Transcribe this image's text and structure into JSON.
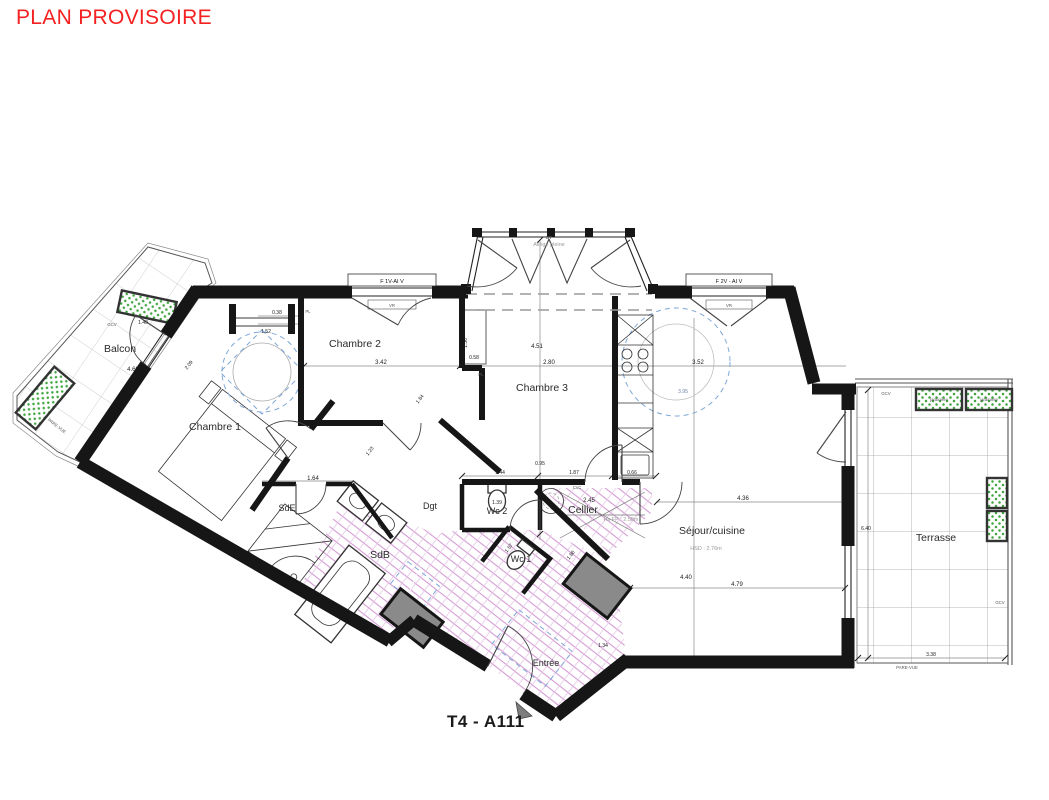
{
  "title": "PLAN PROVISOIRE",
  "plan_code": "T4 - A111",
  "rooms": {
    "balcon": {
      "label": "Balcon"
    },
    "chambre1": {
      "label": "Chambre 1"
    },
    "chambre2": {
      "label": "Chambre 2"
    },
    "chambre3": {
      "label": "Chambre 3"
    },
    "sde": {
      "label": "SdE"
    },
    "sdb": {
      "label": "SdB"
    },
    "dgt": {
      "label": "Dgt"
    },
    "wc2": {
      "label": "Wc 2"
    },
    "wc1": {
      "label": "Wc 1"
    },
    "cellier": {
      "label": "Cellier",
      "height_note": "Hs FP : 2.58m"
    },
    "sejour": {
      "label": "Séjour/cuisine",
      "height_note": "HSD : 2.76m"
    },
    "entree": {
      "label": "Entrée"
    },
    "terrasse": {
      "label": "Terrasse"
    }
  },
  "windows": {
    "f1": "F 1V-AI V",
    "f2": "F 2V - AI V",
    "vr": "VR",
    "bay_tag": "BT",
    "bay_note": "Allège pleine"
  },
  "annotations": {
    "gcv": "GCV",
    "pare_vue": "PARE-VUE",
    "pl": "PL",
    "csc": "CsC",
    "jardiniere": "jardinière"
  },
  "dims": {
    "balcon_length": "4.60",
    "balcon_width": "1.40",
    "ch1_placard_a": "0.38",
    "ch1_placard_b": "1.52",
    "ch1_door": "2.09",
    "ch2_width": "3.42",
    "ch2_side_a": "1.56",
    "ch2_side_b": "0.58",
    "ch3_length": "4.51",
    "ch3_width": "2.80",
    "sejour_a": "4.36",
    "sejour_b": "4.40",
    "sejour_c": "4.79",
    "sejour_d": "3.52",
    "sejour_e": "3.95",
    "kitchen_depth": "0.66",
    "wc2_chain_a": "1.44",
    "wc2_chain_b": "1.87",
    "wc2_top": "0.95",
    "wc2_width": "1.39",
    "sde_width": "1.64",
    "corridor_a": "1.84",
    "corridor_b": "1.23",
    "wc1_a": "1.57",
    "wc1_b": "1.86",
    "entree_a": "1.34",
    "cellier_width": "2.45",
    "terrasse_width": "3.38",
    "terrasse_length": "6.40"
  }
}
